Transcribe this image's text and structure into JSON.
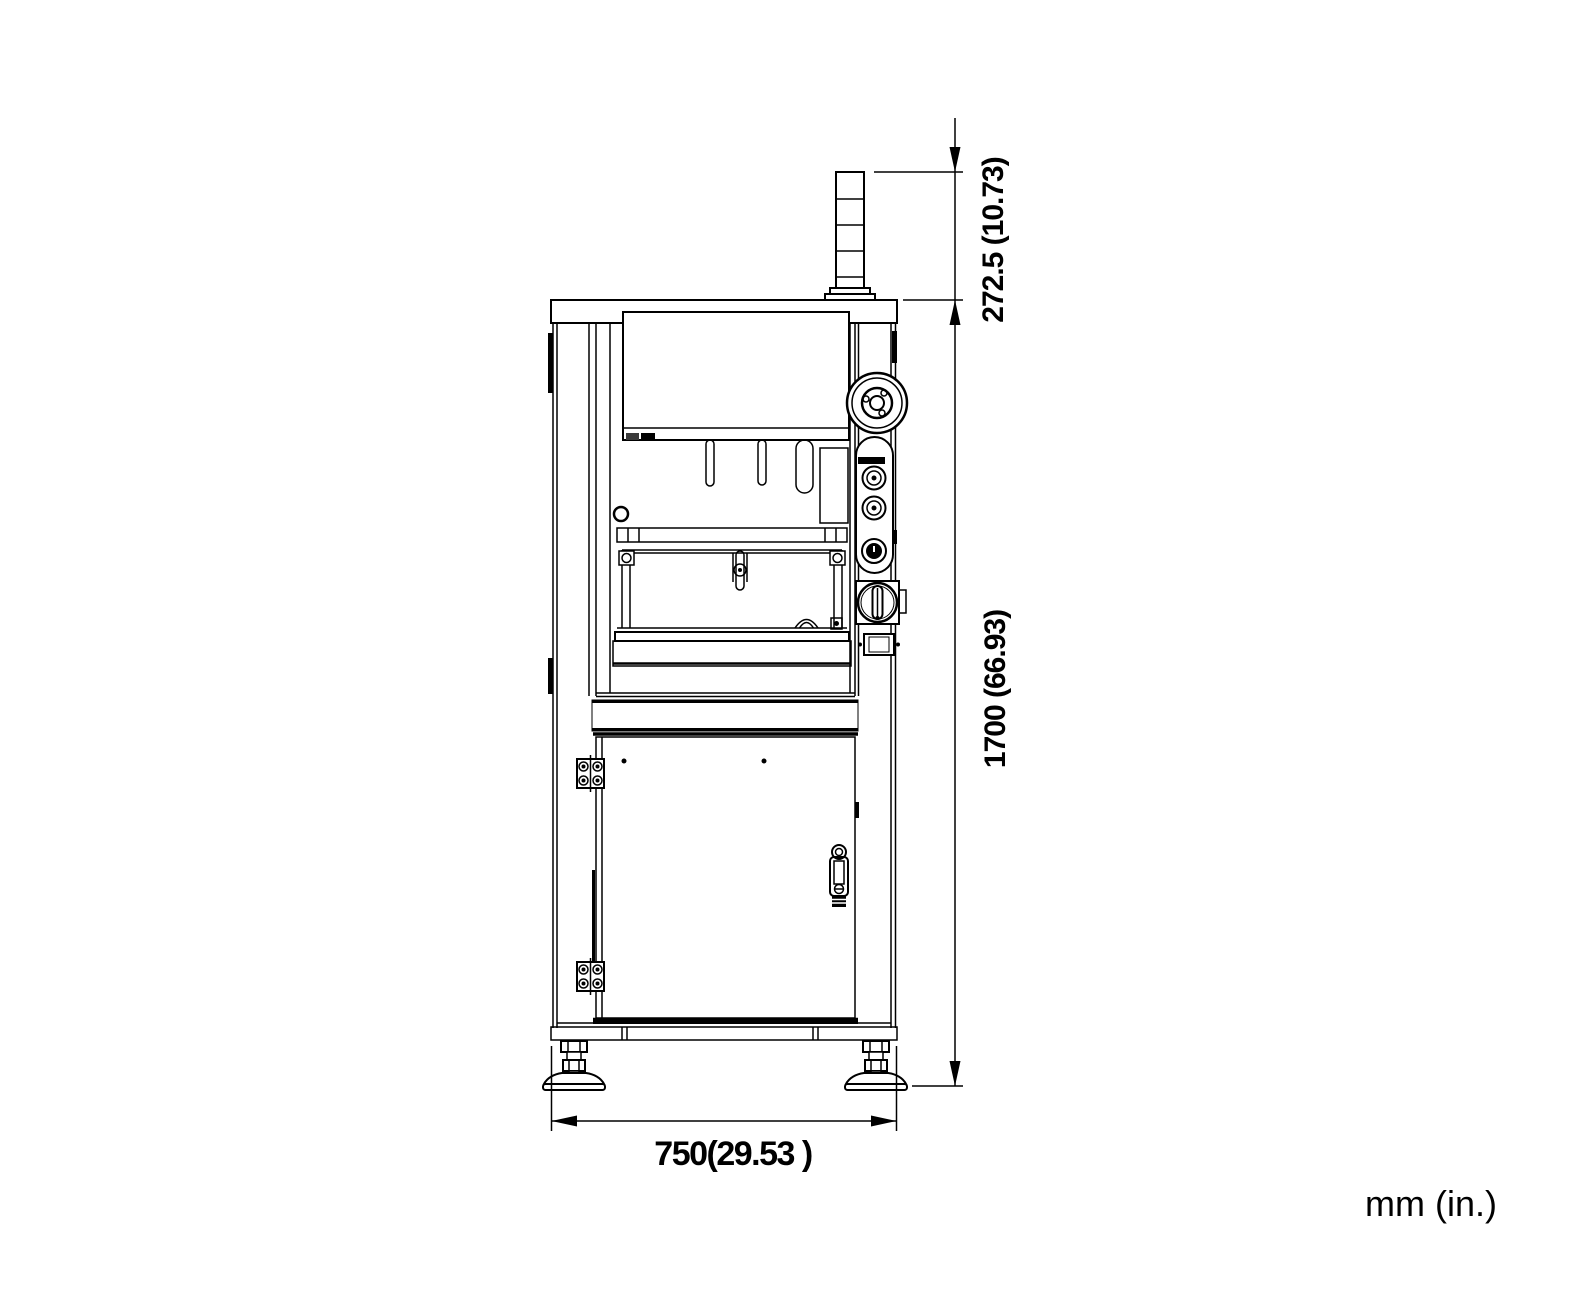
{
  "dimensions": {
    "tower_height_label": "272.5 (10.73)",
    "overall_height_label": "1700 (66.93)",
    "overall_width_label": "750(29.53 )",
    "units_label": "mm (in.)"
  },
  "colors": {
    "line": "#000000",
    "background": "#ffffff"
  }
}
